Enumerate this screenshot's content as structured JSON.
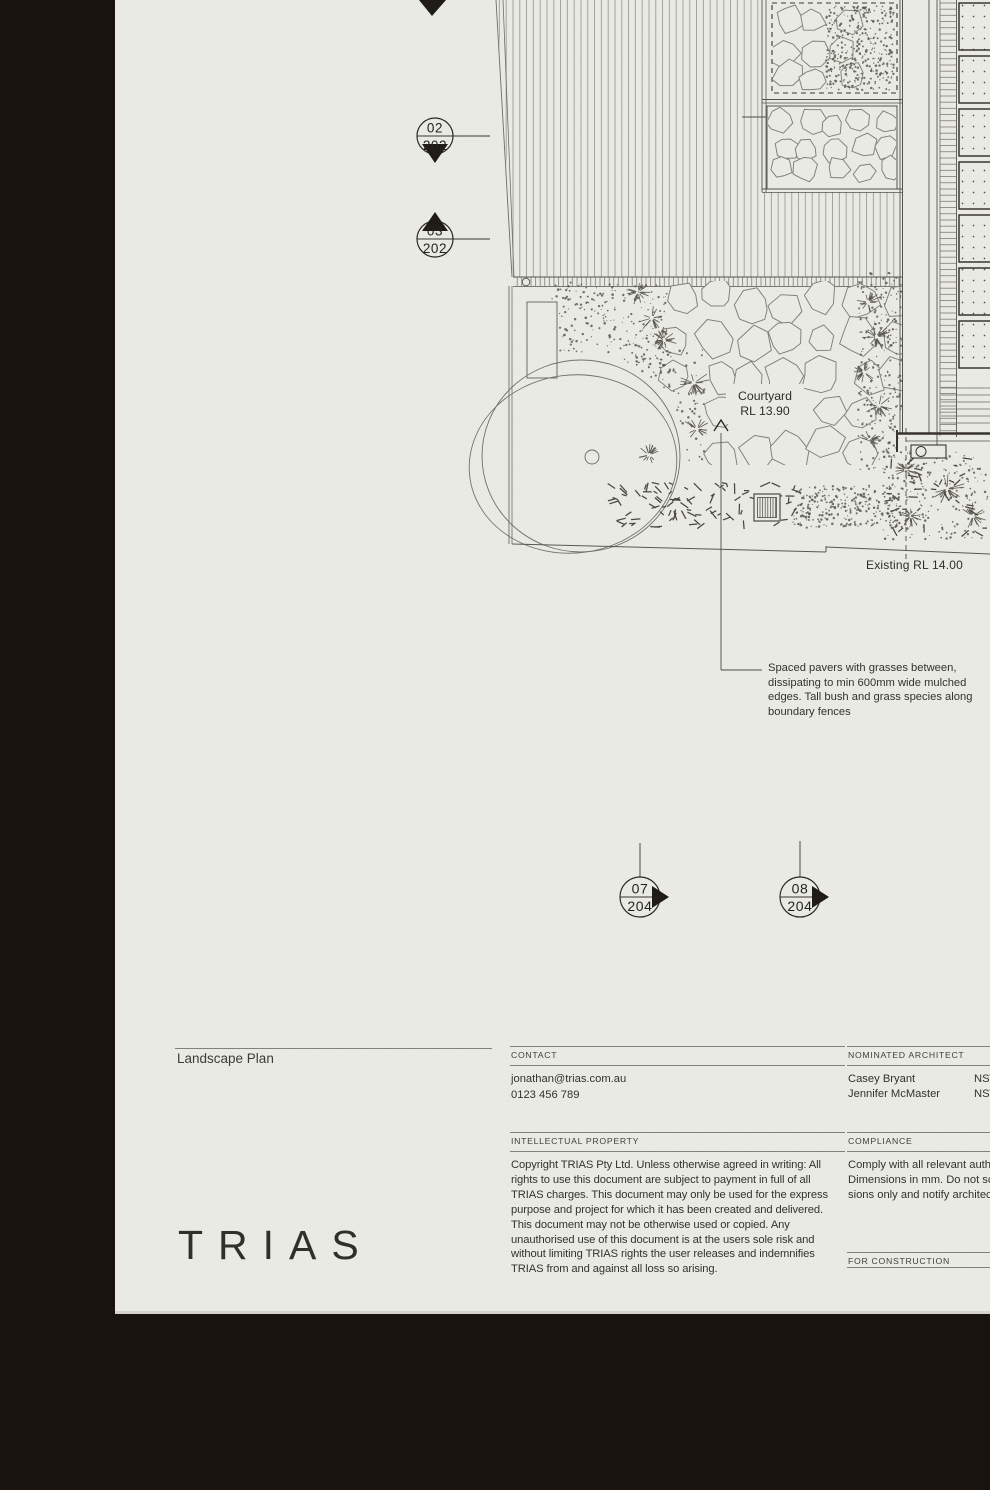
{
  "sheet": {
    "logo": "TRIAS",
    "title": "Landscape Plan"
  },
  "plan": {
    "labels": {
      "courtyard_line1": "Courtyard",
      "courtyard_line2": "RL 13.90",
      "existing_rl": "Existing RL 14.00"
    },
    "annotation_lines": [
      "Spaced pavers with grasses between,",
      "dissipating to min 600mm wide mulched",
      "edges. Tall bush and grass species along",
      "boundary fences"
    ],
    "section_markers": [
      {
        "top": "02",
        "bottom": "202"
      },
      {
        "top": "03",
        "bottom": "202"
      },
      {
        "top": "07",
        "bottom": "204"
      },
      {
        "top": "08",
        "bottom": "204"
      }
    ]
  },
  "titleblock": {
    "contact": {
      "heading": "CONTACT",
      "email": "jonathan@trias.com.au",
      "phone": "0123 456 789"
    },
    "intellectual_property": {
      "heading": "INTELLECTUAL PROPERTY",
      "body": "Copyright TRIAS Pty Ltd. Unless otherwise agreed in writing: All rights to use this document are subject to payment in full of all TRIAS charges. This document may only be used for the express purpose and project for which it has been created and delivered. This document may not be otherwise used or copied. Any unauthorised use of this document is at the users sole risk and without limiting TRIAS rights the user releases and indemnifies TRIAS from and against all loss so arising."
    },
    "nominated_architect": {
      "heading": "NOMINATED ARCHITECT",
      "rows": [
        {
          "name": "Casey Bryant",
          "registration": "NSW"
        },
        {
          "name": "Jennifer McMaster",
          "registration": "NSW"
        }
      ]
    },
    "compliance": {
      "heading": "COMPLIANCE",
      "lines": [
        "Comply with all relevant author",
        "Dimensions in mm. Do not scal",
        "sions only and notify architect i"
      ]
    },
    "status": {
      "heading": "FOR CONSTRUCTION"
    }
  },
  "colors": {
    "background": "#18130f",
    "paper": "#e9eae3",
    "ink": "#55524b",
    "dark": "#26231e"
  }
}
